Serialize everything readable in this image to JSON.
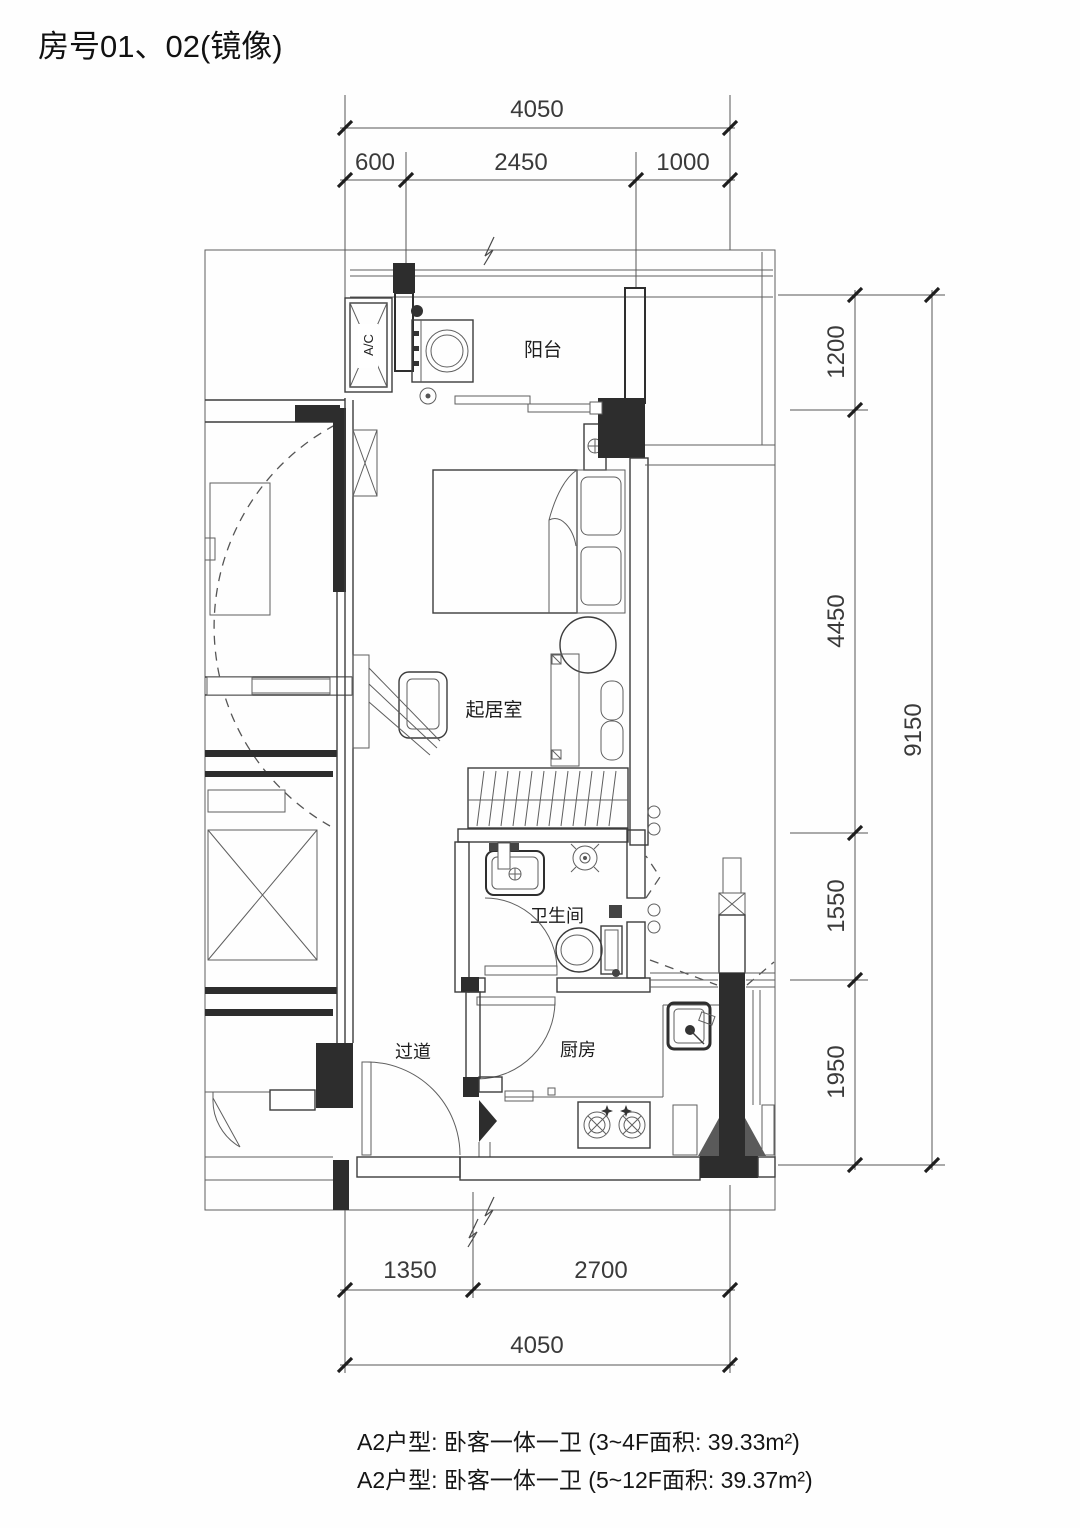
{
  "title": "房号01、02(镜像)",
  "rooms": {
    "balcony": "阳台",
    "living": "起居室",
    "bathroom": "卫生间",
    "kitchen": "厨房",
    "corridor": "过道"
  },
  "equipment": {
    "ac": "A/C"
  },
  "dimensions": {
    "top": {
      "total": "4050",
      "seg1": "600",
      "seg2": "2450",
      "seg3": "1000"
    },
    "right": {
      "seg1": "1200",
      "seg2": "4450",
      "seg3": "1550",
      "seg4": "1950",
      "total": "9150"
    },
    "bottom": {
      "seg1": "1350",
      "seg2": "2700",
      "total": "4050"
    }
  },
  "notes": {
    "line1": "A2户型: 卧客一体一卫 (3~4F面积: 39.33m²)",
    "line2": "A2户型: 卧客一体一卫 (5~12F面积: 39.37m²)"
  },
  "colors": {
    "ink": "#333333",
    "wall_fill": "#2d2d2d",
    "paper": "#ffffff"
  }
}
